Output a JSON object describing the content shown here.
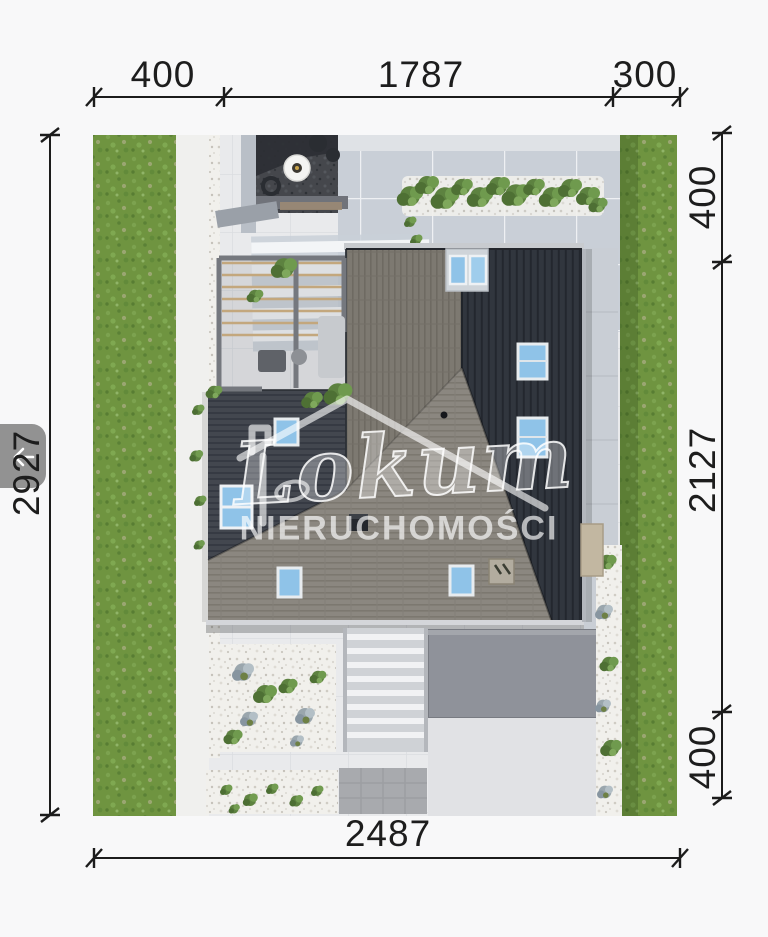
{
  "viewer": {
    "back_nav_icon": "chevron-left"
  },
  "watermark": {
    "brand": "Lokum",
    "subtitle": "NIERUCHOMOŚCI"
  },
  "site_plan": {
    "dimensions": {
      "top": [
        "400",
        "1787",
        "300"
      ],
      "left": [
        "2927"
      ],
      "right": [
        "400",
        "2127",
        "400"
      ],
      "bottom": [
        "2487"
      ]
    }
  },
  "palette": {
    "lawn": "#6c9440",
    "roof_dark": "#31363e",
    "roof_gable": "#7d7971",
    "roof_south": "#8b8780",
    "paving": "#e9eaec",
    "skylight": "#8fc3e8",
    "dimension_ink": "#1c1c1c",
    "nav_pill": "#8b8b8b"
  }
}
